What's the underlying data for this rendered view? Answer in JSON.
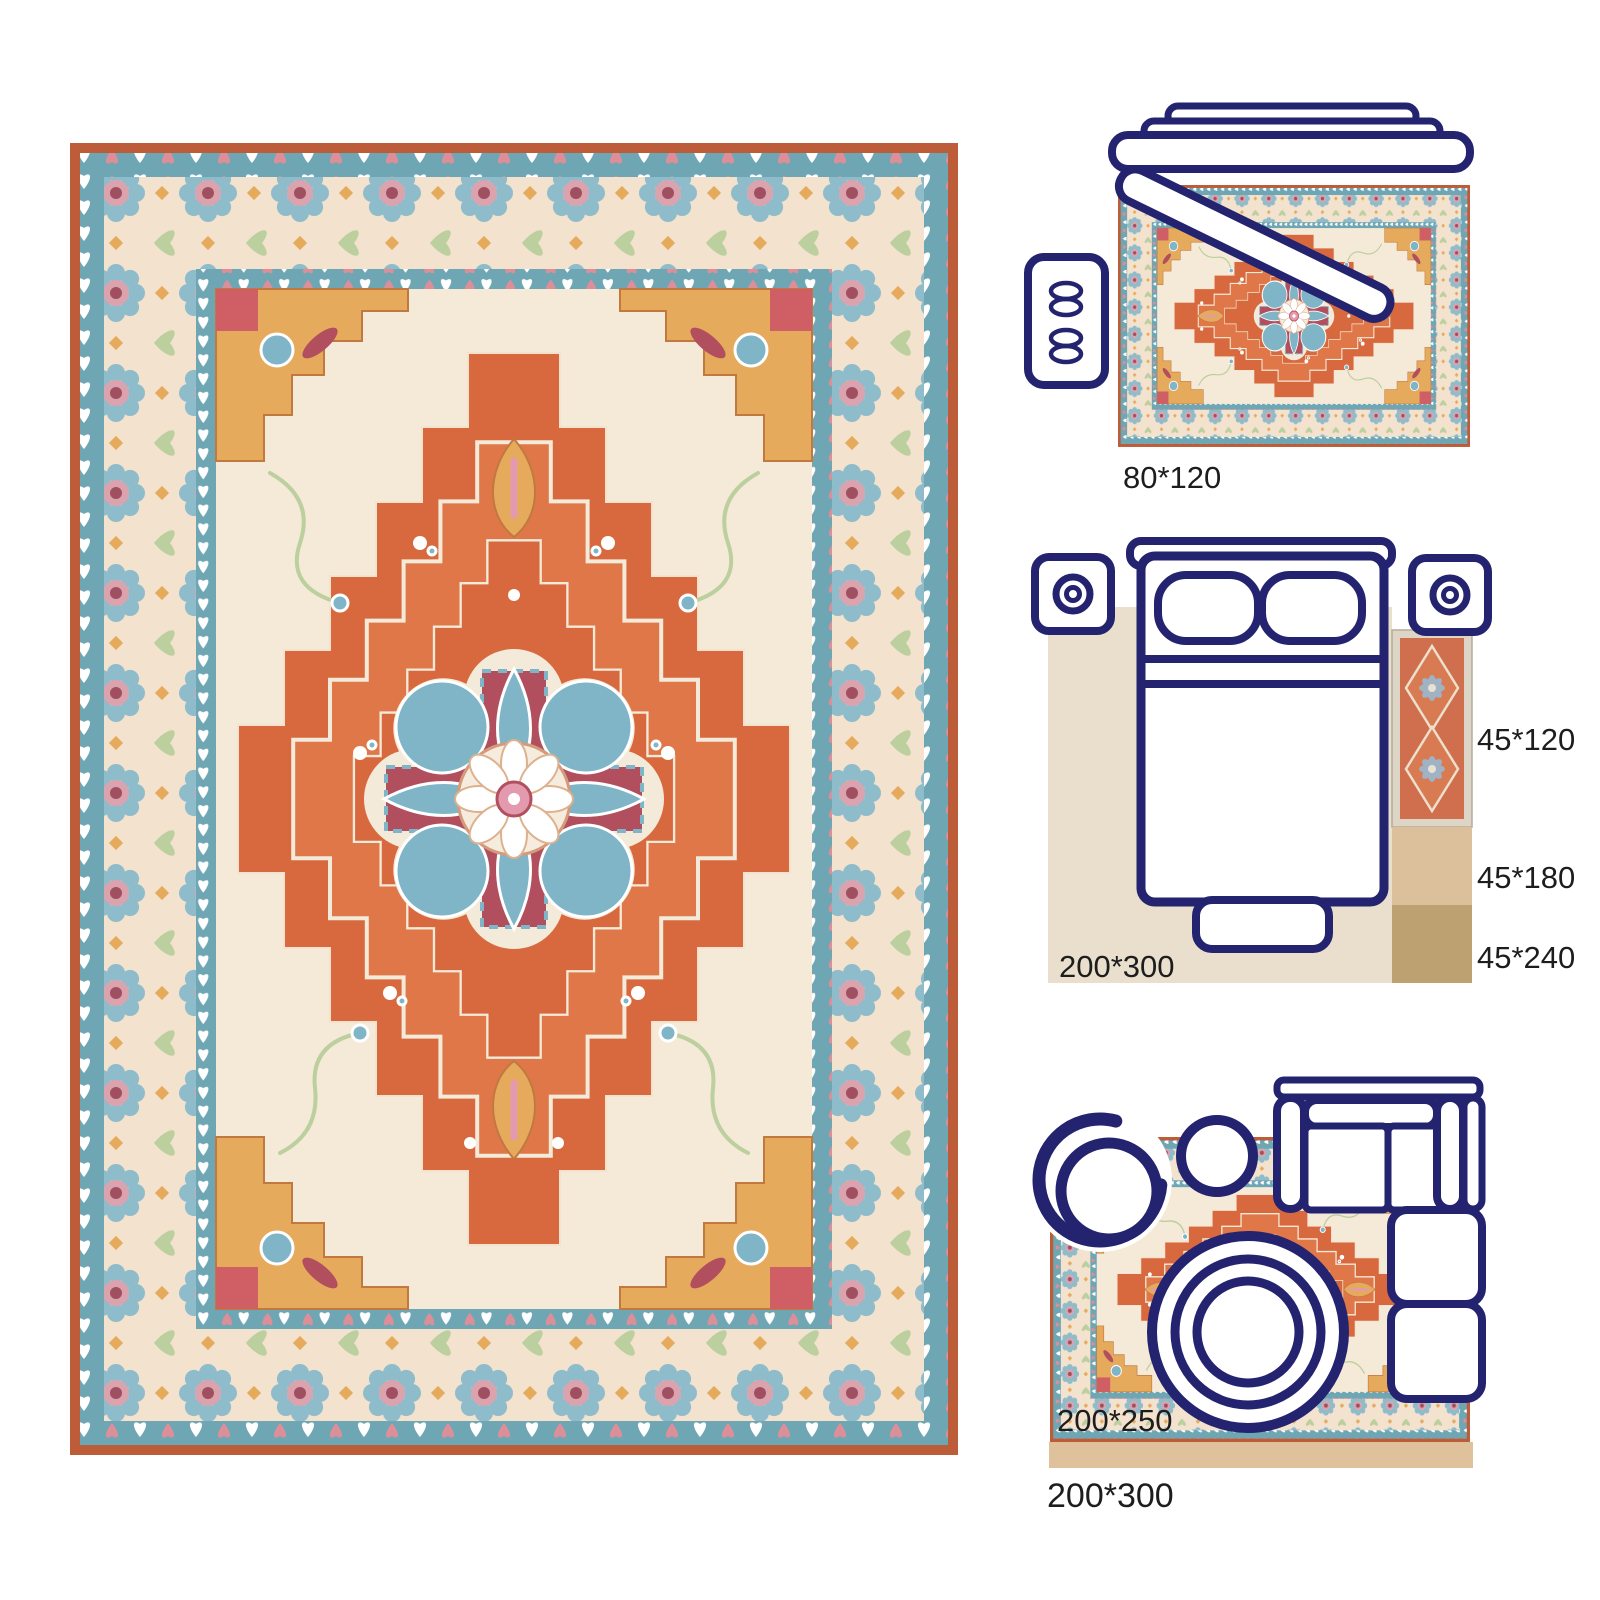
{
  "labels": {
    "top_rug": "80*120",
    "runner": "45*120",
    "runner_mid": "45*180",
    "runner_long": "45*240",
    "bedroom": "200*300",
    "living_small": "200*250",
    "living_large": "200*300"
  },
  "colors": {
    "navy": "#23236f",
    "ink": "#1d1d1d",
    "rust": "#bc5c38",
    "tealband": "#6ea6b4",
    "heartpink": "#dc8f98",
    "creamborder": "#f3e2cd",
    "field": "#f5e9d7",
    "orange": "#d8693e",
    "orange2": "#df7748",
    "gold": "#e6aa5d",
    "maroon": "#b24f5e",
    "medteal": "#7fb5c7",
    "cream2": "#f4ead9",
    "pink": "#e39aae",
    "sage": "#bccf9f",
    "rosetteteal": "#8fbccb",
    "rosettepink": "#daa3ad",
    "rosettemaroon": "#a04f60",
    "beige": "#e9dfcc",
    "tan1": "#dcbf9b",
    "tan2": "#bda171",
    "tan3": "#dfc29c",
    "runnerfield": "#cf6f4d",
    "runnerborder": "#ddd5c6",
    "runnerstar": "#9fb3c4"
  }
}
